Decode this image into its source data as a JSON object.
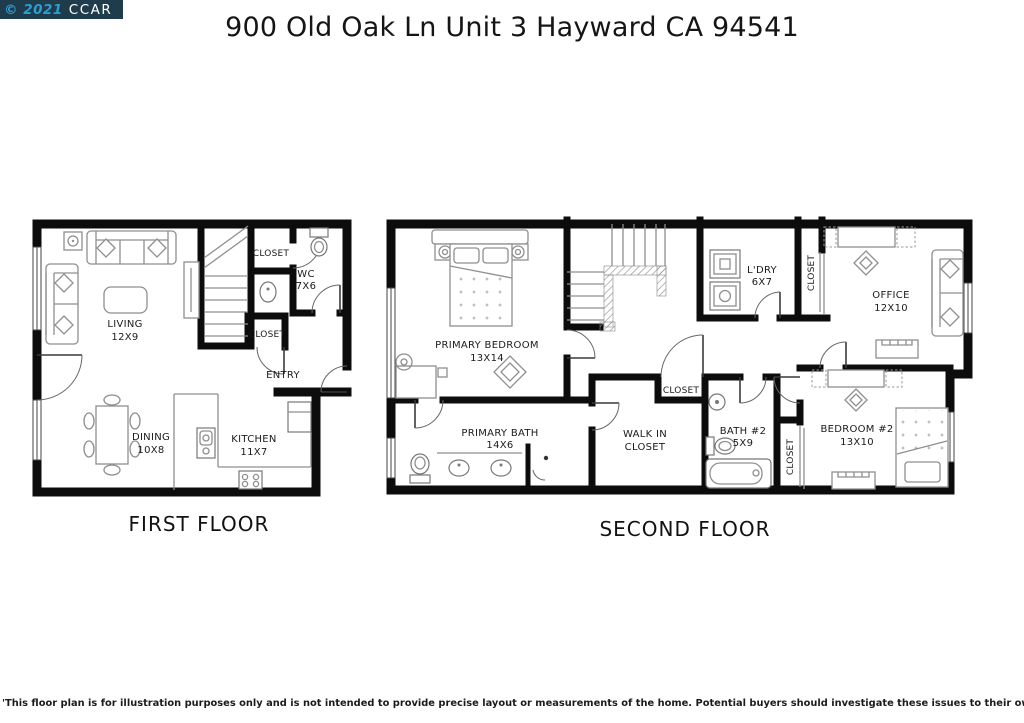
{
  "watermark": {
    "year_text": "© 2021",
    "org": "CCAR",
    "bg_color": "#1e3c4b",
    "year_color": "#2b9fd3",
    "org_color": "#ffffff"
  },
  "title": "900 Old Oak Ln Unit 3 Hayward CA 94541",
  "first_floor": {
    "caption": "FIRST FLOOR",
    "rooms": {
      "living": {
        "line1": "LIVING",
        "line2": "12X9"
      },
      "closet_upper": {
        "line1": "CLOSET"
      },
      "wc": {
        "line1": "WC",
        "line2": "7X6"
      },
      "closet_lower": {
        "line1": "CLOSET"
      },
      "entry": {
        "line1": "ENTRY"
      },
      "dining": {
        "line1": "DINING",
        "line2": "10X8"
      },
      "kitchen": {
        "line1": "KITCHEN",
        "line2": "11X7"
      }
    }
  },
  "second_floor": {
    "caption": "SECOND FLOOR",
    "rooms": {
      "primary_bedroom": {
        "line1": "PRIMARY BEDROOM",
        "line2": "13X14"
      },
      "laundry": {
        "line1": "L'DRY",
        "line2": "6X7"
      },
      "closet_office": {
        "line1": "CLOSET"
      },
      "office": {
        "line1": "OFFICE",
        "line2": "12X10"
      },
      "closet_hall": {
        "line1": "CLOSET"
      },
      "primary_bath": {
        "line1": "PRIMARY BATH",
        "line2": "14X6"
      },
      "walk_in_closet": {
        "line1": "WALK IN",
        "line2": "CLOSET"
      },
      "bath2": {
        "line1": "BATH #2",
        "line2": "5X9"
      },
      "closet_bedroom2": {
        "line1": "CLOSET"
      },
      "bedroom2": {
        "line1": "BEDROOM #2",
        "line2": "13X10"
      }
    }
  },
  "disclaimer": "'This floor plan is for illustration purposes only and is not intended to provide precise layout or measurements of the home. Potential buyers should investigate these issues to their own satisfaction. '"
}
